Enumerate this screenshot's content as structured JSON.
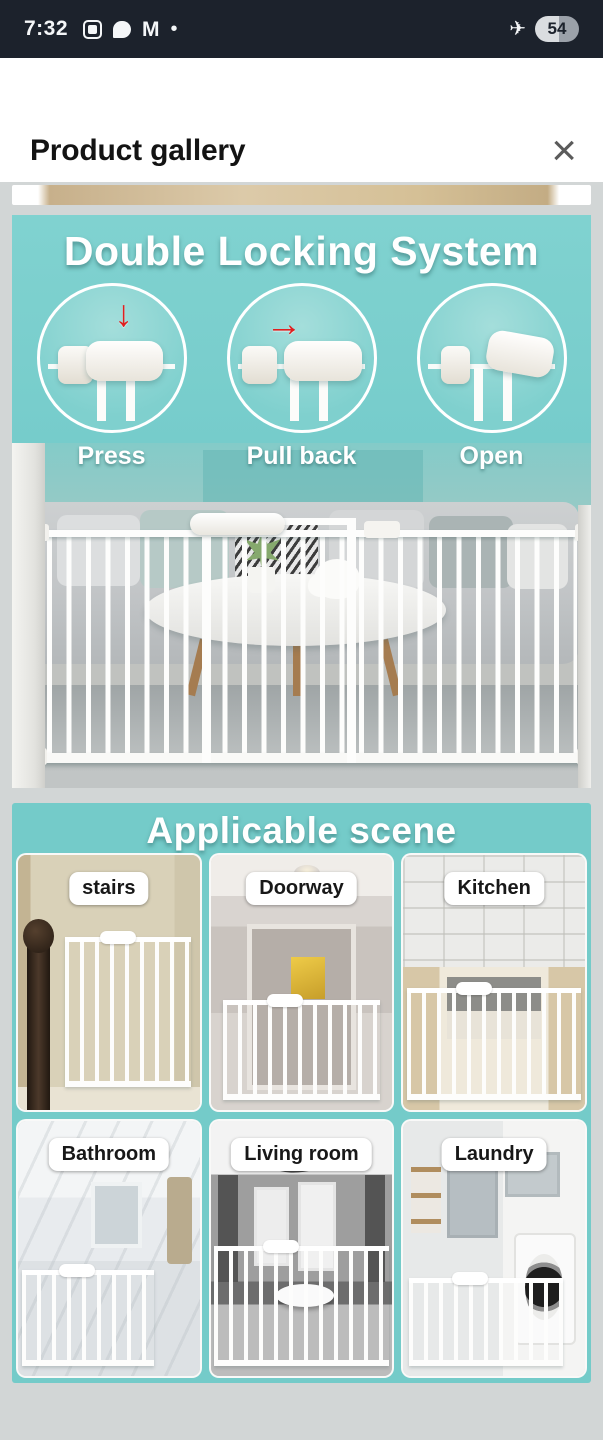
{
  "status_bar": {
    "time": "7:32",
    "gmail_glyph": "M",
    "dot_glyph": "•",
    "airplane_glyph": "✈",
    "battery_level": "54"
  },
  "header": {
    "title": "Product gallery",
    "close_glyph": "×"
  },
  "gallery": {
    "locking_image": {
      "title": "Double Locking System",
      "steps": [
        {
          "label": "Press",
          "arrow_glyph": "↓"
        },
        {
          "label": "Pull back",
          "arrow_glyph": "→"
        },
        {
          "label": "Open",
          "arrow_glyph": ""
        }
      ]
    },
    "scene_image": {
      "title": "Applicable scene",
      "scenes": [
        {
          "label": "stairs"
        },
        {
          "label": "Doorway"
        },
        {
          "label": "Kitchen"
        },
        {
          "label": "Bathroom"
        },
        {
          "label": "Living room"
        },
        {
          "label": "Laundry"
        }
      ]
    }
  },
  "colors": {
    "teal": "#76cccb",
    "status_bar_bg": "#1c222c",
    "gallery_bg": "#d2d6d6",
    "arrow_red": "#e01f1f"
  }
}
